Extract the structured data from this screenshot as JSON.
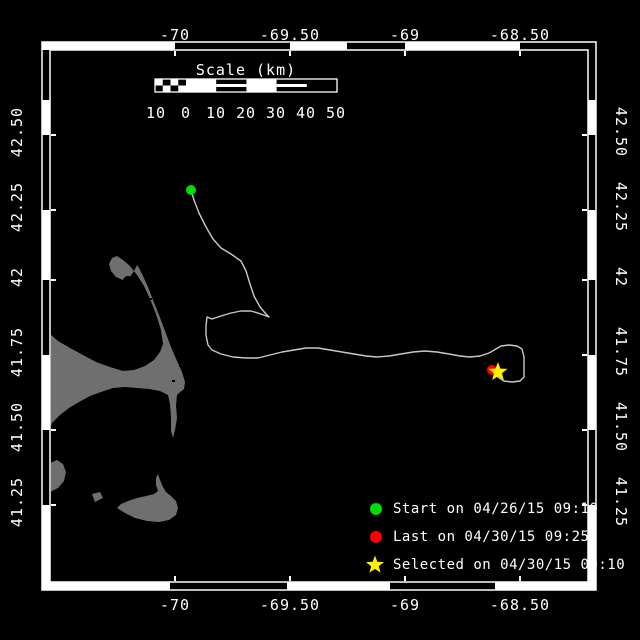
{
  "map": {
    "colors": {
      "background": "#000000",
      "frame": "#ffffff",
      "land": "#6f6f6f",
      "track": "#c8c8c8",
      "start_marker": "#00dd00",
      "last_marker": "#ff0000",
      "selected_marker": "#ffee00",
      "text": "#ffffff"
    },
    "axes": {
      "top_ticks": [
        "-70",
        "-69.50",
        "-69",
        "-68.50"
      ],
      "bottom_ticks": [
        "-70",
        "-69.50",
        "-69",
        "-68.50"
      ],
      "left_ticks": [
        "42.50",
        "42.25",
        "42",
        "41.75",
        "41.50",
        "41.25"
      ],
      "right_ticks": [
        "42.50",
        "42.25",
        "42",
        "41.75",
        "41.50",
        "41.25"
      ]
    },
    "scalebar": {
      "title": "Scale (km)",
      "tick_labels": [
        "10",
        "0",
        "10",
        "20",
        "30",
        "40",
        "50"
      ]
    },
    "legend": [
      {
        "marker": "circle",
        "color": "#00dd00",
        "label": "Start on 04/26/15 09:10"
      },
      {
        "marker": "circle",
        "color": "#ff0000",
        "label": "Last on 04/30/15 09:25"
      },
      {
        "marker": "star",
        "color": "#ffee00",
        "label": "Selected on 04/30/15 09:10"
      }
    ],
    "markers": {
      "start": {
        "x": 191,
        "y": 190
      },
      "last": {
        "x": 492,
        "y": 370
      },
      "selected": {
        "x": 498,
        "y": 372
      }
    },
    "track": [
      [
        191,
        190
      ],
      [
        194,
        200
      ],
      [
        199,
        213
      ],
      [
        206,
        227
      ],
      [
        213,
        239
      ],
      [
        221,
        248
      ],
      [
        231,
        254
      ],
      [
        241,
        261
      ],
      [
        246,
        271
      ],
      [
        250,
        284
      ],
      [
        254,
        296
      ],
      [
        260,
        307
      ],
      [
        266,
        314
      ],
      [
        269,
        317
      ],
      [
        261,
        314
      ],
      [
        251,
        311
      ],
      [
        241,
        311
      ],
      [
        231,
        313
      ],
      [
        221,
        316
      ],
      [
        212,
        319
      ],
      [
        207,
        317
      ],
      [
        206,
        326
      ],
      [
        206,
        335
      ],
      [
        208,
        345
      ],
      [
        212,
        350
      ],
      [
        221,
        354
      ],
      [
        233,
        357
      ],
      [
        246,
        358
      ],
      [
        258,
        358
      ],
      [
        270,
        355
      ],
      [
        282,
        352
      ],
      [
        294,
        350
      ],
      [
        306,
        348
      ],
      [
        318,
        348
      ],
      [
        330,
        350
      ],
      [
        342,
        352
      ],
      [
        354,
        354
      ],
      [
        366,
        356
      ],
      [
        377,
        357
      ],
      [
        389,
        356
      ],
      [
        401,
        354
      ],
      [
        413,
        352
      ],
      [
        425,
        351
      ],
      [
        437,
        352
      ],
      [
        449,
        354
      ],
      [
        460,
        356
      ],
      [
        470,
        357
      ],
      [
        480,
        356
      ],
      [
        489,
        353
      ],
      [
        496,
        349
      ],
      [
        501,
        346
      ],
      [
        509,
        345
      ],
      [
        517,
        346
      ],
      [
        522,
        349
      ],
      [
        524,
        357
      ],
      [
        524,
        367
      ],
      [
        524,
        377
      ],
      [
        520,
        381
      ],
      [
        512,
        382
      ],
      [
        504,
        381
      ],
      [
        498,
        377
      ],
      [
        494,
        373
      ]
    ],
    "land": {
      "main": [
        [
          50,
          334
        ],
        [
          58,
          341
        ],
        [
          70,
          348
        ],
        [
          83,
          355
        ],
        [
          96,
          362
        ],
        [
          110,
          367
        ],
        [
          123,
          371
        ],
        [
          134,
          370
        ],
        [
          145,
          366
        ],
        [
          154,
          360
        ],
        [
          160,
          352
        ],
        [
          163,
          344
        ],
        [
          161,
          330
        ],
        [
          156,
          314
        ],
        [
          150,
          299
        ],
        [
          144,
          286
        ],
        [
          137,
          275
        ],
        [
          130,
          266
        ],
        [
          123,
          260
        ],
        [
          117,
          256
        ],
        [
          112,
          258
        ],
        [
          109,
          264
        ],
        [
          111,
          271
        ],
        [
          116,
          277
        ],
        [
          123,
          280
        ],
        [
          130,
          277
        ],
        [
          134,
          271
        ],
        [
          137,
          265
        ],
        [
          139,
          268
        ],
        [
          143,
          276
        ],
        [
          148,
          287
        ],
        [
          153,
          300
        ],
        [
          159,
          315
        ],
        [
          165,
          331
        ],
        [
          171,
          347
        ],
        [
          177,
          361
        ],
        [
          182,
          372
        ],
        [
          185,
          382
        ],
        [
          184,
          389
        ],
        [
          179,
          393
        ],
        [
          177,
          395
        ],
        [
          176,
          406
        ],
        [
          177,
          418
        ],
        [
          175,
          430
        ],
        [
          173,
          438
        ],
        [
          171,
          431
        ],
        [
          171,
          417
        ],
        [
          170,
          404
        ],
        [
          168,
          395
        ],
        [
          160,
          391
        ],
        [
          149,
          389
        ],
        [
          137,
          388
        ],
        [
          125,
          387
        ],
        [
          113,
          388
        ],
        [
          101,
          392
        ],
        [
          90,
          396
        ],
        [
          79,
          402
        ],
        [
          69,
          408
        ],
        [
          60,
          415
        ],
        [
          52,
          423
        ],
        [
          50,
          430
        ],
        [
          50,
          438
        ]
      ],
      "vineyard_island": [
        [
          50,
          463
        ],
        [
          57,
          460
        ],
        [
          63,
          464
        ],
        [
          66,
          472
        ],
        [
          64,
          481
        ],
        [
          58,
          488
        ],
        [
          50,
          492
        ]
      ],
      "muskeget_island": [
        [
          92,
          494
        ],
        [
          100,
          492
        ],
        [
          103,
          498
        ],
        [
          95,
          502
        ]
      ],
      "nantucket_island": [
        [
          117,
          508
        ],
        [
          125,
          513
        ],
        [
          135,
          518
        ],
        [
          147,
          521
        ],
        [
          159,
          522
        ],
        [
          169,
          520
        ],
        [
          176,
          515
        ],
        [
          178,
          508
        ],
        [
          176,
          501
        ],
        [
          171,
          496
        ],
        [
          166,
          492
        ],
        [
          163,
          487
        ],
        [
          160,
          480
        ],
        [
          158,
          474
        ],
        [
          156,
          478
        ],
        [
          156,
          485
        ],
        [
          158,
          491
        ],
        [
          154,
          494
        ],
        [
          146,
          496
        ],
        [
          137,
          498
        ],
        [
          128,
          501
        ],
        [
          121,
          504
        ]
      ],
      "bay_spit": [
        [
          88,
          374
        ],
        [
          106,
          372
        ]
      ],
      "harbor_notch": {
        "cx": 128,
        "cy": 284,
        "rx": 6,
        "ry": 8
      },
      "specks": [
        [
          175,
          351,
          3,
          3
        ],
        [
          179,
          364,
          2,
          3
        ],
        [
          172,
          380,
          3,
          2
        ],
        [
          157,
          305,
          2,
          2
        ],
        [
          150,
          298,
          2,
          2
        ]
      ]
    },
    "geometry": {
      "outer_rect": [
        42,
        42,
        596,
        590
      ],
      "inner_rect": [
        50,
        50,
        588,
        582
      ],
      "band_white": {
        "top": [
          [
            42,
            175
          ],
          [
            290,
            347
          ],
          [
            405,
            520
          ]
        ],
        "bottom": [
          [
            42,
            170
          ],
          [
            287,
            390
          ],
          [
            495,
            596
          ]
        ],
        "left": [
          [
            100,
            135
          ],
          [
            210,
            280
          ],
          [
            355,
            430
          ],
          [
            505,
            582
          ]
        ],
        "right": [
          [
            100,
            135
          ],
          [
            210,
            280
          ],
          [
            355,
            430
          ],
          [
            505,
            582
          ]
        ]
      },
      "tick_x": [
        175,
        290,
        405,
        520
      ],
      "tick_y": [
        135,
        210,
        280,
        355,
        430,
        505
      ],
      "label_top_y": 26,
      "label_bottom_y": 596,
      "label_left_x": 17,
      "label_right_x": 621,
      "scalebar": {
        "x": 155,
        "y": 79,
        "w": 182,
        "h": 13,
        "checks_w": 31,
        "label_xs": [
          156,
          186,
          216,
          246,
          276,
          306,
          336
        ],
        "labels_y": 104,
        "title_y": 61,
        "title_x": 246
      },
      "legend": {
        "marker_x": 376,
        "text_x": 393,
        "row_ys": [
          509,
          537,
          565
        ]
      }
    }
  }
}
